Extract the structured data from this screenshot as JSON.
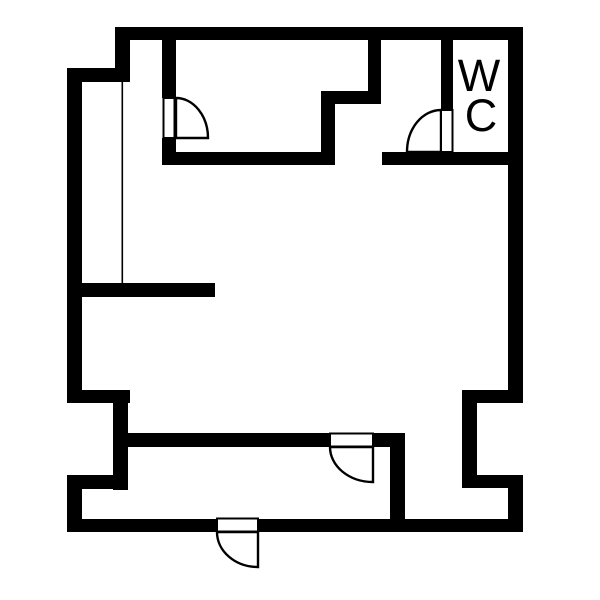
{
  "labels": {
    "wc": {
      "line1": "W",
      "line2": "C"
    }
  },
  "colors": {
    "wall": "#000000",
    "background": "#ffffff",
    "door_fill": "#ffffff"
  },
  "floor_plan": {
    "canvas": {
      "width": 600,
      "height": 600
    },
    "walls": [
      {
        "name": "outer-top-wall",
        "x": 115,
        "y": 27,
        "w": 408,
        "h": 13
      },
      {
        "name": "outer-topleft-step-v",
        "x": 115,
        "y": 27,
        "w": 15,
        "h": 55
      },
      {
        "name": "outer-topleft-step-h",
        "x": 67,
        "y": 68,
        "w": 63,
        "h": 14
      },
      {
        "name": "outer-left-wall-upper",
        "x": 67,
        "y": 68,
        "w": 15,
        "h": 335
      },
      {
        "name": "left-notch-top-wall",
        "x": 67,
        "y": 390,
        "w": 63,
        "h": 13
      },
      {
        "name": "left-notch-inner-wall",
        "x": 113,
        "y": 390,
        "w": 15,
        "h": 100
      },
      {
        "name": "left-notch-bottom-wall",
        "x": 67,
        "y": 475,
        "w": 61,
        "h": 14
      },
      {
        "name": "outer-left-wall-lower",
        "x": 67,
        "y": 475,
        "w": 15,
        "h": 57
      },
      {
        "name": "outer-bottom-wall-left",
        "x": 67,
        "y": 519,
        "w": 150,
        "h": 13
      },
      {
        "name": "outer-bottom-wall-right",
        "x": 258,
        "y": 519,
        "w": 265,
        "h": 13
      },
      {
        "name": "outer-right-wall-lower",
        "x": 508,
        "y": 475,
        "w": 15,
        "h": 57
      },
      {
        "name": "right-notch-bottom-wall",
        "x": 477,
        "y": 475,
        "w": 46,
        "h": 13
      },
      {
        "name": "right-notch-inner-wall",
        "x": 462,
        "y": 390,
        "w": 15,
        "h": 98
      },
      {
        "name": "right-notch-top-wall",
        "x": 462,
        "y": 390,
        "w": 61,
        "h": 13
      },
      {
        "name": "outer-right-wall-upper",
        "x": 508,
        "y": 27,
        "w": 15,
        "h": 376
      },
      {
        "name": "room1-wall-above-door",
        "x": 162,
        "y": 37,
        "w": 14,
        "h": 61
      },
      {
        "name": "room1-wall-below-door",
        "x": 162,
        "y": 138,
        "w": 14,
        "h": 27
      },
      {
        "name": "hall-top-wall-left",
        "x": 162,
        "y": 152,
        "w": 173,
        "h": 13
      },
      {
        "name": "hall-top-wall-right",
        "x": 382,
        "y": 152,
        "w": 127,
        "h": 13
      },
      {
        "name": "room2-step-wall-v-right",
        "x": 368,
        "y": 27,
        "w": 13,
        "h": 77
      },
      {
        "name": "room2-step-wall-h",
        "x": 321,
        "y": 91,
        "w": 60,
        "h": 13
      },
      {
        "name": "room2-step-wall-v-left",
        "x": 321,
        "y": 91,
        "w": 14,
        "h": 74
      },
      {
        "name": "left-room-divider-wall",
        "x": 82,
        "y": 283,
        "w": 133,
        "h": 14
      },
      {
        "name": "lower-wall-left",
        "x": 127,
        "y": 433,
        "w": 203,
        "h": 14
      },
      {
        "name": "lower-wall-right",
        "x": 373,
        "y": 433,
        "w": 19,
        "h": 14
      },
      {
        "name": "lower-vertical-wall",
        "x": 390,
        "y": 433,
        "w": 15,
        "h": 86
      },
      {
        "name": "wc-wall-above-door",
        "x": 441,
        "y": 27,
        "w": 12,
        "h": 83
      }
    ],
    "thin_lines": [
      {
        "name": "left-room-partition-line",
        "x": 121.5,
        "y": 82,
        "w": 1.6,
        "h": 201
      }
    ],
    "doors": [
      {
        "name": "room-top-left-door",
        "leaf": {
          "x": 163.5,
          "y": 98,
          "w": 11,
          "h": 40
        },
        "swing": "M 176 98 A 32 40 0 0 1 208 138 L 176 138 Z"
      },
      {
        "name": "wc-door",
        "leaf": {
          "x": 441,
          "y": 110,
          "w": 11.5,
          "h": 42
        },
        "swing": "M 441 110 A 34 42 0 0 0 407 152 L 441 152 Z"
      },
      {
        "name": "entrance-door",
        "leaf": {
          "x": 217,
          "y": 518.5,
          "w": 41,
          "h": 13
        },
        "swing": "M 217 532 A 41 35 0 0 0 258 567 L 258 532 Z"
      },
      {
        "name": "hall-lower-door",
        "leaf": {
          "x": 330,
          "y": 433.5,
          "w": 43,
          "h": 13
        },
        "swing": "M 330 447 A 43 35 0 0 0 373 482 L 373 447 Z"
      }
    ],
    "label_positions": {
      "wc_line1": {
        "x": 479,
        "y": 91
      },
      "wc_line2": {
        "x": 481,
        "y": 131
      }
    }
  }
}
